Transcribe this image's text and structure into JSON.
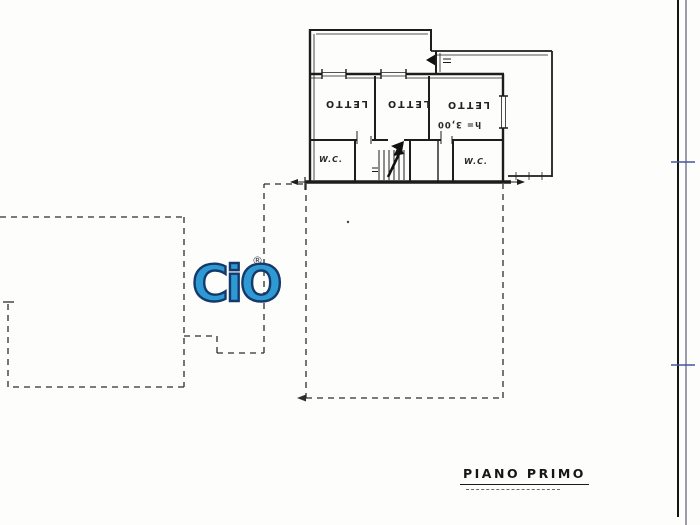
{
  "watermark": {
    "text": "CiO",
    "registered_mark": "®"
  },
  "floor_plan": {
    "bedroom_labels": [
      "LETTO",
      "LETTO",
      "LETTO"
    ],
    "ceiling_height_note": "h= 3,00",
    "wc_labels": [
      "W.C.",
      "W.C."
    ],
    "caption": "PIANO PRIMO"
  },
  "colors": {
    "ink": "#1d1d1d",
    "dashed_footprint": "#2e2e2e",
    "logo_fill": "#2d9ad3",
    "logo_outline": "#16396b",
    "margin_line_black": "#151515",
    "margin_line_navy": "#3b3b5e",
    "margin_tick_blue": "#4a55a2"
  }
}
